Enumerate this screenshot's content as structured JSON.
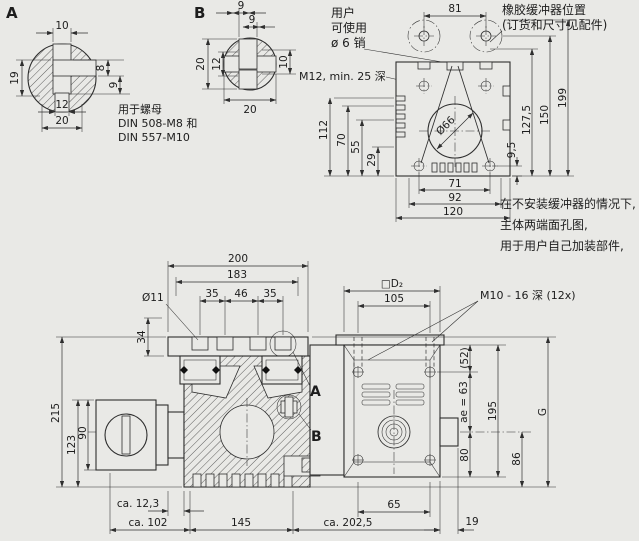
{
  "drawing": {
    "colors": {
      "background": "#e9e9e6",
      "line": "#2e2e2e"
    },
    "view_a": {
      "label": "A",
      "dim_top": "10",
      "dim_right_upper": "8",
      "dim_right_lower": "9",
      "dim_left": "19",
      "dim_bottom_inner": "12",
      "dim_bottom_outer": "20",
      "note_lines": [
        "用于螺母",
        "DIN 508-M8 和",
        "DIN 557-M10"
      ]
    },
    "view_b": {
      "label": "B",
      "dim_top_outer": "9",
      "dim_top_inner": "9",
      "dim_left_outer": "20",
      "dim_left_inner": "12",
      "dim_right": "10",
      "dim_bottom": "20"
    },
    "end_view": {
      "pin_note_lines": [
        "用户",
        "可使用",
        "ø 6 销"
      ],
      "thread_note": "M12, min. 25 深",
      "buffer_note_lines": [
        "橡胶缓冲器位置",
        "(订货和尺寸见配件)"
      ],
      "buffer_spacing": "81",
      "bore": "Ø66",
      "dim_112": "112",
      "dim_70": "70",
      "dim_55": "55",
      "dim_29": "29",
      "dim_71": "71",
      "dim_92": "92",
      "dim_120": "120",
      "dim_9_5": "9,5",
      "dim_127_5": "127,5",
      "dim_150": "150",
      "dim_199": "199",
      "note_lines": [
        "在不安装缓冲器的情况下,",
        "主体两端面孔图,",
        "用于用户自己加装部件,"
      ]
    },
    "main_view": {
      "label_a": "A",
      "label_b": "B",
      "dim_200": "200",
      "dim_183": "183",
      "dim_hole": "Ø11",
      "dim_35a": "35",
      "dim_46": "46",
      "dim_35b": "35",
      "dim_34": "34",
      "dim_215": "215",
      "dim_123": "123",
      "dim_90": "90",
      "dim_ca12_3": "ca. 12,3",
      "dim_ca102": "ca. 102",
      "dim_145": "145",
      "dim_ca202_5": "ca. 202,5",
      "dim_65": "65",
      "dim_19": "19",
      "dim_52": "(52)",
      "dim_ae": "ae = 63",
      "dim_195": "195",
      "dim_80": "80",
      "dim_86": "86",
      "dim_g": "G",
      "dim_square": "□D₂",
      "dim_105": "105",
      "thread_note": "M10 - 16 深 (12x)"
    }
  }
}
